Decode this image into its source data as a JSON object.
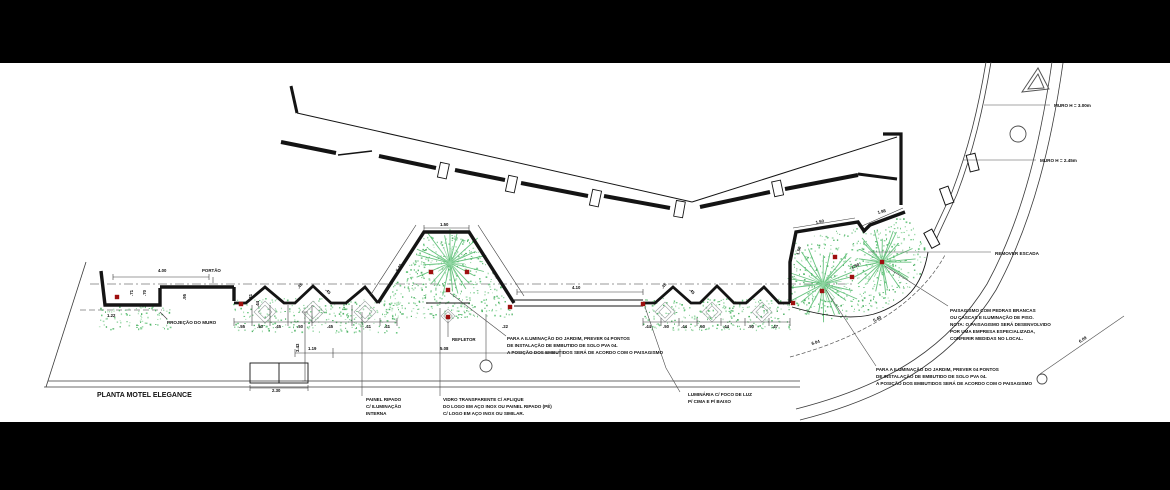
{
  "drawing_title": {
    "text": "PLANTA MOTEL ELEGANCE"
  },
  "colors": {
    "paper": "#ffffff",
    "frame": "#000000",
    "wall_line": "#141414",
    "leader_line": "#4a4a4a",
    "plant_green": "#6fc985",
    "palm_green": "#57bd71",
    "refletor_red": "#9e0f0f",
    "dim_text": "#111111"
  },
  "wall_labels": [
    {
      "name": "drawing-title",
      "text": "PLANTA MOTEL ELEGANCE",
      "x": 97,
      "y": 397,
      "size": 7
    },
    {
      "name": "label-muro-h300",
      "text": "MURO H = 3.00m",
      "x": 1054,
      "y": 107,
      "size": 4.6
    },
    {
      "name": "label-muro-h245",
      "text": "MURO H = 2.45m",
      "x": 1040,
      "y": 162,
      "size": 4.6
    },
    {
      "name": "label-remover-escada",
      "text": "REMOVER ESCADA",
      "x": 995,
      "y": 255,
      "size": 4.6
    },
    {
      "name": "label-portao",
      "text": "PORTÃO",
      "x": 202,
      "y": 272,
      "size": 4.4
    },
    {
      "name": "label-projecao-muro",
      "text": "PROJEÇÃO DO MURO",
      "x": 167,
      "y": 324,
      "size": 4.6
    },
    {
      "name": "label-refletor",
      "text": "REFLETOR",
      "x": 452,
      "y": 341,
      "size": 4.4
    }
  ],
  "notes": [
    {
      "name": "note-iluminacao-jardim-centro",
      "x": 507,
      "y": 340,
      "lines": [
        "PARA A ILUMINAÇÃO DO JARDIM, PREVER 04 PONTOS",
        "DE INSTALAÇÃO DE EMBUTIDO DE SOLO PVA 04.",
        "A POSIÇÃO DOS EMBUTIDOS SERÁ DE ACORDO COM O PAISAGISMO"
      ]
    },
    {
      "name": "note-paisagismo",
      "x": 950,
      "y": 312,
      "lines": [
        "PAISAGISMO COM PEDRAS BRANCAS",
        "OU CASCAS E ILUMINAÇÃO DE PISO.",
        "NOTA: O PAISAGISMO SERÁ DESENVOLVIDO",
        "POR UMA EMPRESA ESPECIALIZADA,",
        "CONFERIR MEDIDAS NO LOCAL."
      ]
    },
    {
      "name": "note-iluminacao-jardim-direita",
      "x": 876,
      "y": 371,
      "lines": [
        "PARA A ILUMINAÇÃO DO JARDIM, PREVER 04 PONTOS",
        "DE INSTALAÇÃO DE EMBUTIDO DE SOLO PVA 04.",
        "A POSIÇÃO DOS EMBUTIDOS SERÁ DE ACORDO COM O PAISAGISMO"
      ]
    },
    {
      "name": "note-painel-ripado",
      "x": 366,
      "y": 401,
      "lines": [
        "PAINEL RIPADO",
        "C/ ILUMINAÇÃO",
        "INTERNA"
      ]
    },
    {
      "name": "note-vidro-logo",
      "x": 443,
      "y": 401,
      "lines": [
        "VIDRO TRANSPARENTE C/ APLIQUE",
        "DO LOGO EM AÇO INOX OU PAINEL RIPADO (PÉ)",
        "C/ LOGO EM AÇO INOX OU SIMILAR."
      ]
    },
    {
      "name": "note-luminaria",
      "x": 688,
      "y": 396,
      "lines": [
        "LUMINÁRIA C/ FOCO DE LUZ",
        "P/ CIMA E P/ BAIXO"
      ]
    }
  ],
  "dimensions": [
    {
      "t": "4.00",
      "x": 158,
      "y": 272,
      "r": 0
    },
    {
      "t": "1.22",
      "x": 107,
      "y": 317,
      "r": 0
    },
    {
      "t": ".71",
      "x": 133,
      "y": 296,
      "r": -90
    },
    {
      "t": ".70",
      "x": 146,
      "y": 296,
      "r": -90
    },
    {
      "t": ".95",
      "x": 186,
      "y": 300,
      "r": -90
    },
    {
      "t": ".41",
      "x": 252,
      "y": 300,
      "r": -90
    },
    {
      "t": ".44",
      "x": 259,
      "y": 307,
      "r": -90
    },
    {
      "t": ".55",
      "x": 239,
      "y": 328,
      "r": 0
    },
    {
      "t": ".50",
      "x": 257,
      "y": 328,
      "r": 0
    },
    {
      "t": ".45",
      "x": 275,
      "y": 328,
      "r": 0
    },
    {
      "t": ".50",
      "x": 297,
      "y": 328,
      "r": 0
    },
    {
      "t": ".45",
      "x": 327,
      "y": 328,
      "r": 0
    },
    {
      "t": ".41",
      "x": 365,
      "y": 328,
      "r": 0
    },
    {
      "t": ".41",
      "x": 384,
      "y": 328,
      "r": 0
    },
    {
      "t": ".22",
      "x": 502,
      "y": 328,
      "r": 0
    },
    {
      "t": "1.50",
      "x": 440,
      "y": 226,
      "r": 0
    },
    {
      "t": "5.40",
      "x": 398,
      "y": 272,
      "r": -58
    },
    {
      "t": "5.40",
      "x": 492,
      "y": 272,
      "r": 58
    },
    {
      "t": "4.10",
      "x": 572,
      "y": 289,
      "r": 0
    },
    {
      "t": ".44",
      "x": 645,
      "y": 328,
      "r": 0
    },
    {
      "t": ".50",
      "x": 663,
      "y": 328,
      "r": 0
    },
    {
      "t": ".44",
      "x": 681,
      "y": 328,
      "r": 0
    },
    {
      "t": ".50",
      "x": 699,
      "y": 328,
      "r": 0
    },
    {
      "t": ".44",
      "x": 723,
      "y": 328,
      "r": 0
    },
    {
      "t": ".50",
      "x": 748,
      "y": 328,
      "r": 0
    },
    {
      "t": ".47",
      "x": 772,
      "y": 328,
      "r": 0
    },
    {
      "t": "1.19",
      "x": 308,
      "y": 350,
      "r": 0
    },
    {
      "t": "5.08",
      "x": 440,
      "y": 350,
      "r": 0
    },
    {
      "t": "2.30",
      "x": 272,
      "y": 392,
      "r": 0
    },
    {
      "t": "3.43",
      "x": 299,
      "y": 352,
      "r": -90
    },
    {
      "t": "1.50",
      "x": 816,
      "y": 224,
      "r": -12
    },
    {
      "t": "1.98",
      "x": 878,
      "y": 214,
      "r": -14
    },
    {
      "t": "1.50",
      "x": 799,
      "y": 255,
      "r": -76
    },
    {
      "t": "1.50",
      "x": 852,
      "y": 269,
      "r": -24
    },
    {
      "t": "5.40",
      "x": 874,
      "y": 322,
      "r": -27
    },
    {
      "t": "6.04",
      "x": 812,
      "y": 345,
      "r": -17
    },
    {
      "t": "6.09",
      "x": 1080,
      "y": 343,
      "r": -33
    },
    {
      "t": ".45",
      "x": 299,
      "y": 289,
      "r": -50
    },
    {
      "t": ".45",
      "x": 325,
      "y": 290,
      "r": 50
    },
    {
      "t": ".45",
      "x": 663,
      "y": 289,
      "r": -50
    },
    {
      "t": ".45",
      "x": 689,
      "y": 290,
      "r": 50
    }
  ]
}
